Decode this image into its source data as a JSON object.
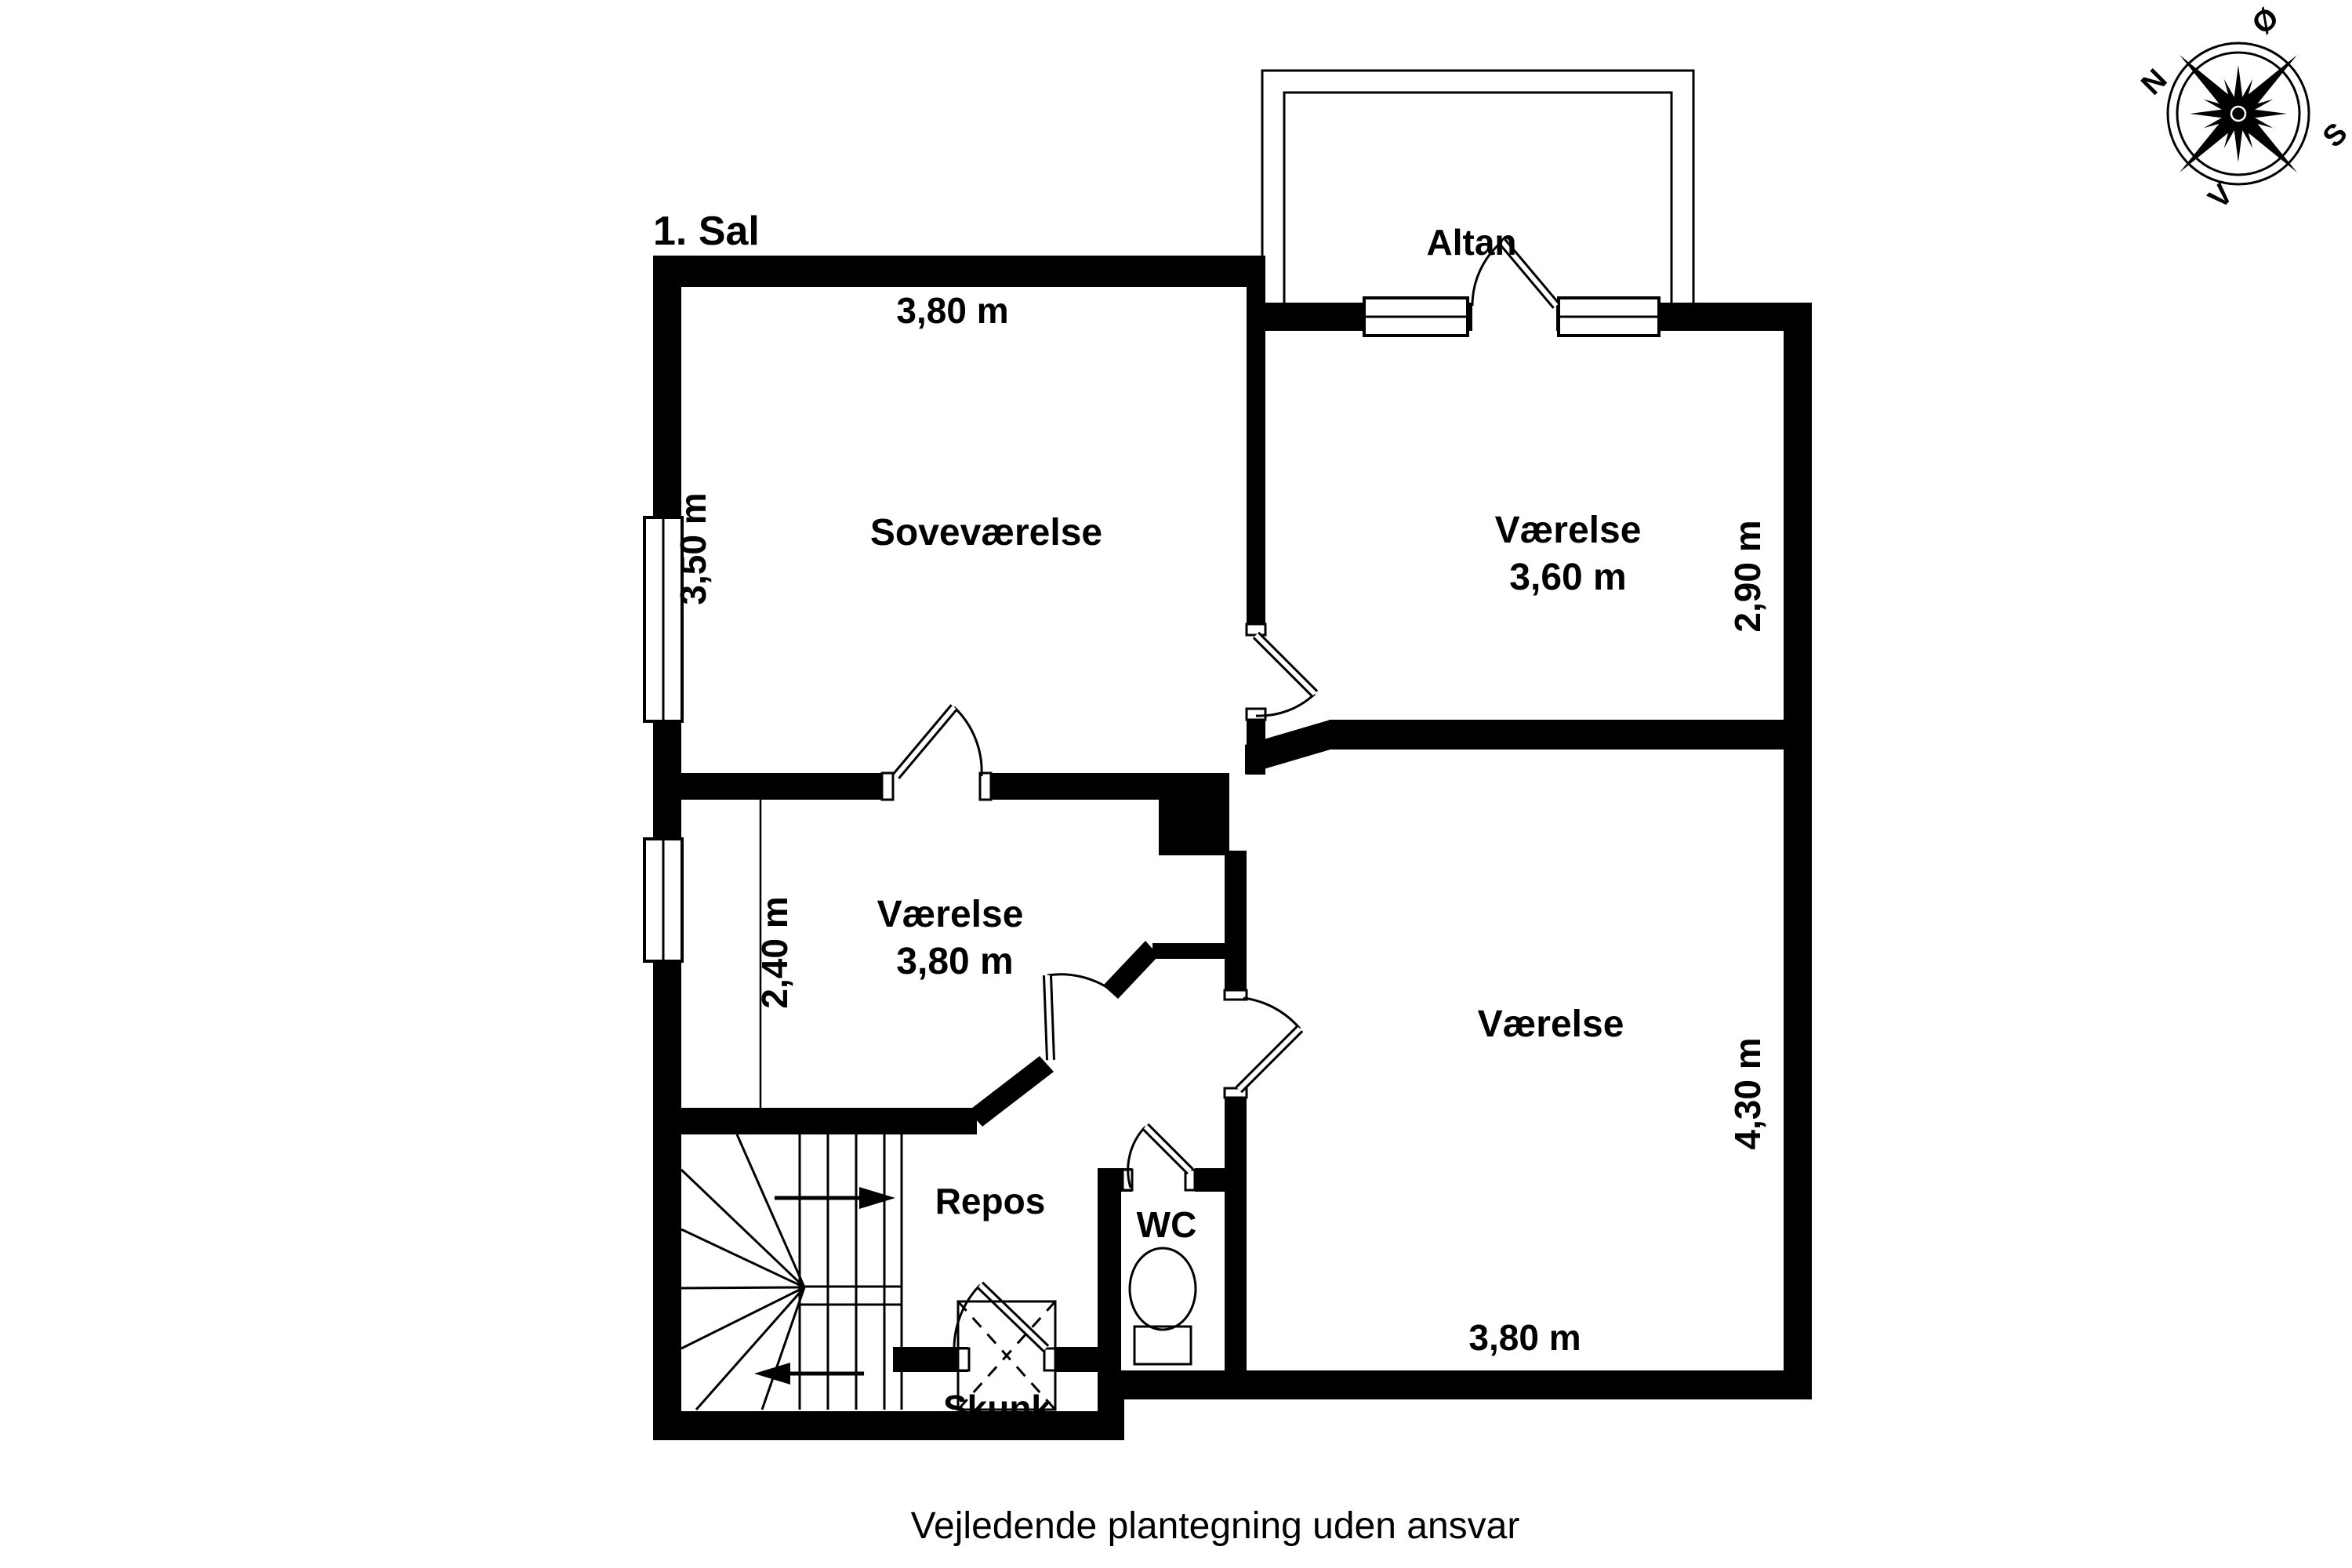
{
  "page": {
    "title": "1. Sal",
    "caption": "Vejledende plantegning uden ansvar"
  },
  "rooms": {
    "altan": "Altan",
    "sovevaerelse": "Soveværelse",
    "vaerelse_ne": "Værelse",
    "vaerelse_mid": "Værelse",
    "vaerelse_se": "Værelse",
    "repos": "Repos",
    "wc": "WC",
    "skunk": "Skunk"
  },
  "dimensions": {
    "sove_width": "3,80 m",
    "sove_height": "3,50 m",
    "ne_width": "3,60 m",
    "ne_height": "2,90 m",
    "mid_width": "3,80 m",
    "mid_height": "2,40 m",
    "se_width": "3,80 m",
    "se_height": "4,30 m"
  },
  "compass": {
    "north": "N",
    "east": "Ø",
    "south": "S",
    "west": "V"
  },
  "colors": {
    "wall": "#000000",
    "background": "#ffffff"
  }
}
